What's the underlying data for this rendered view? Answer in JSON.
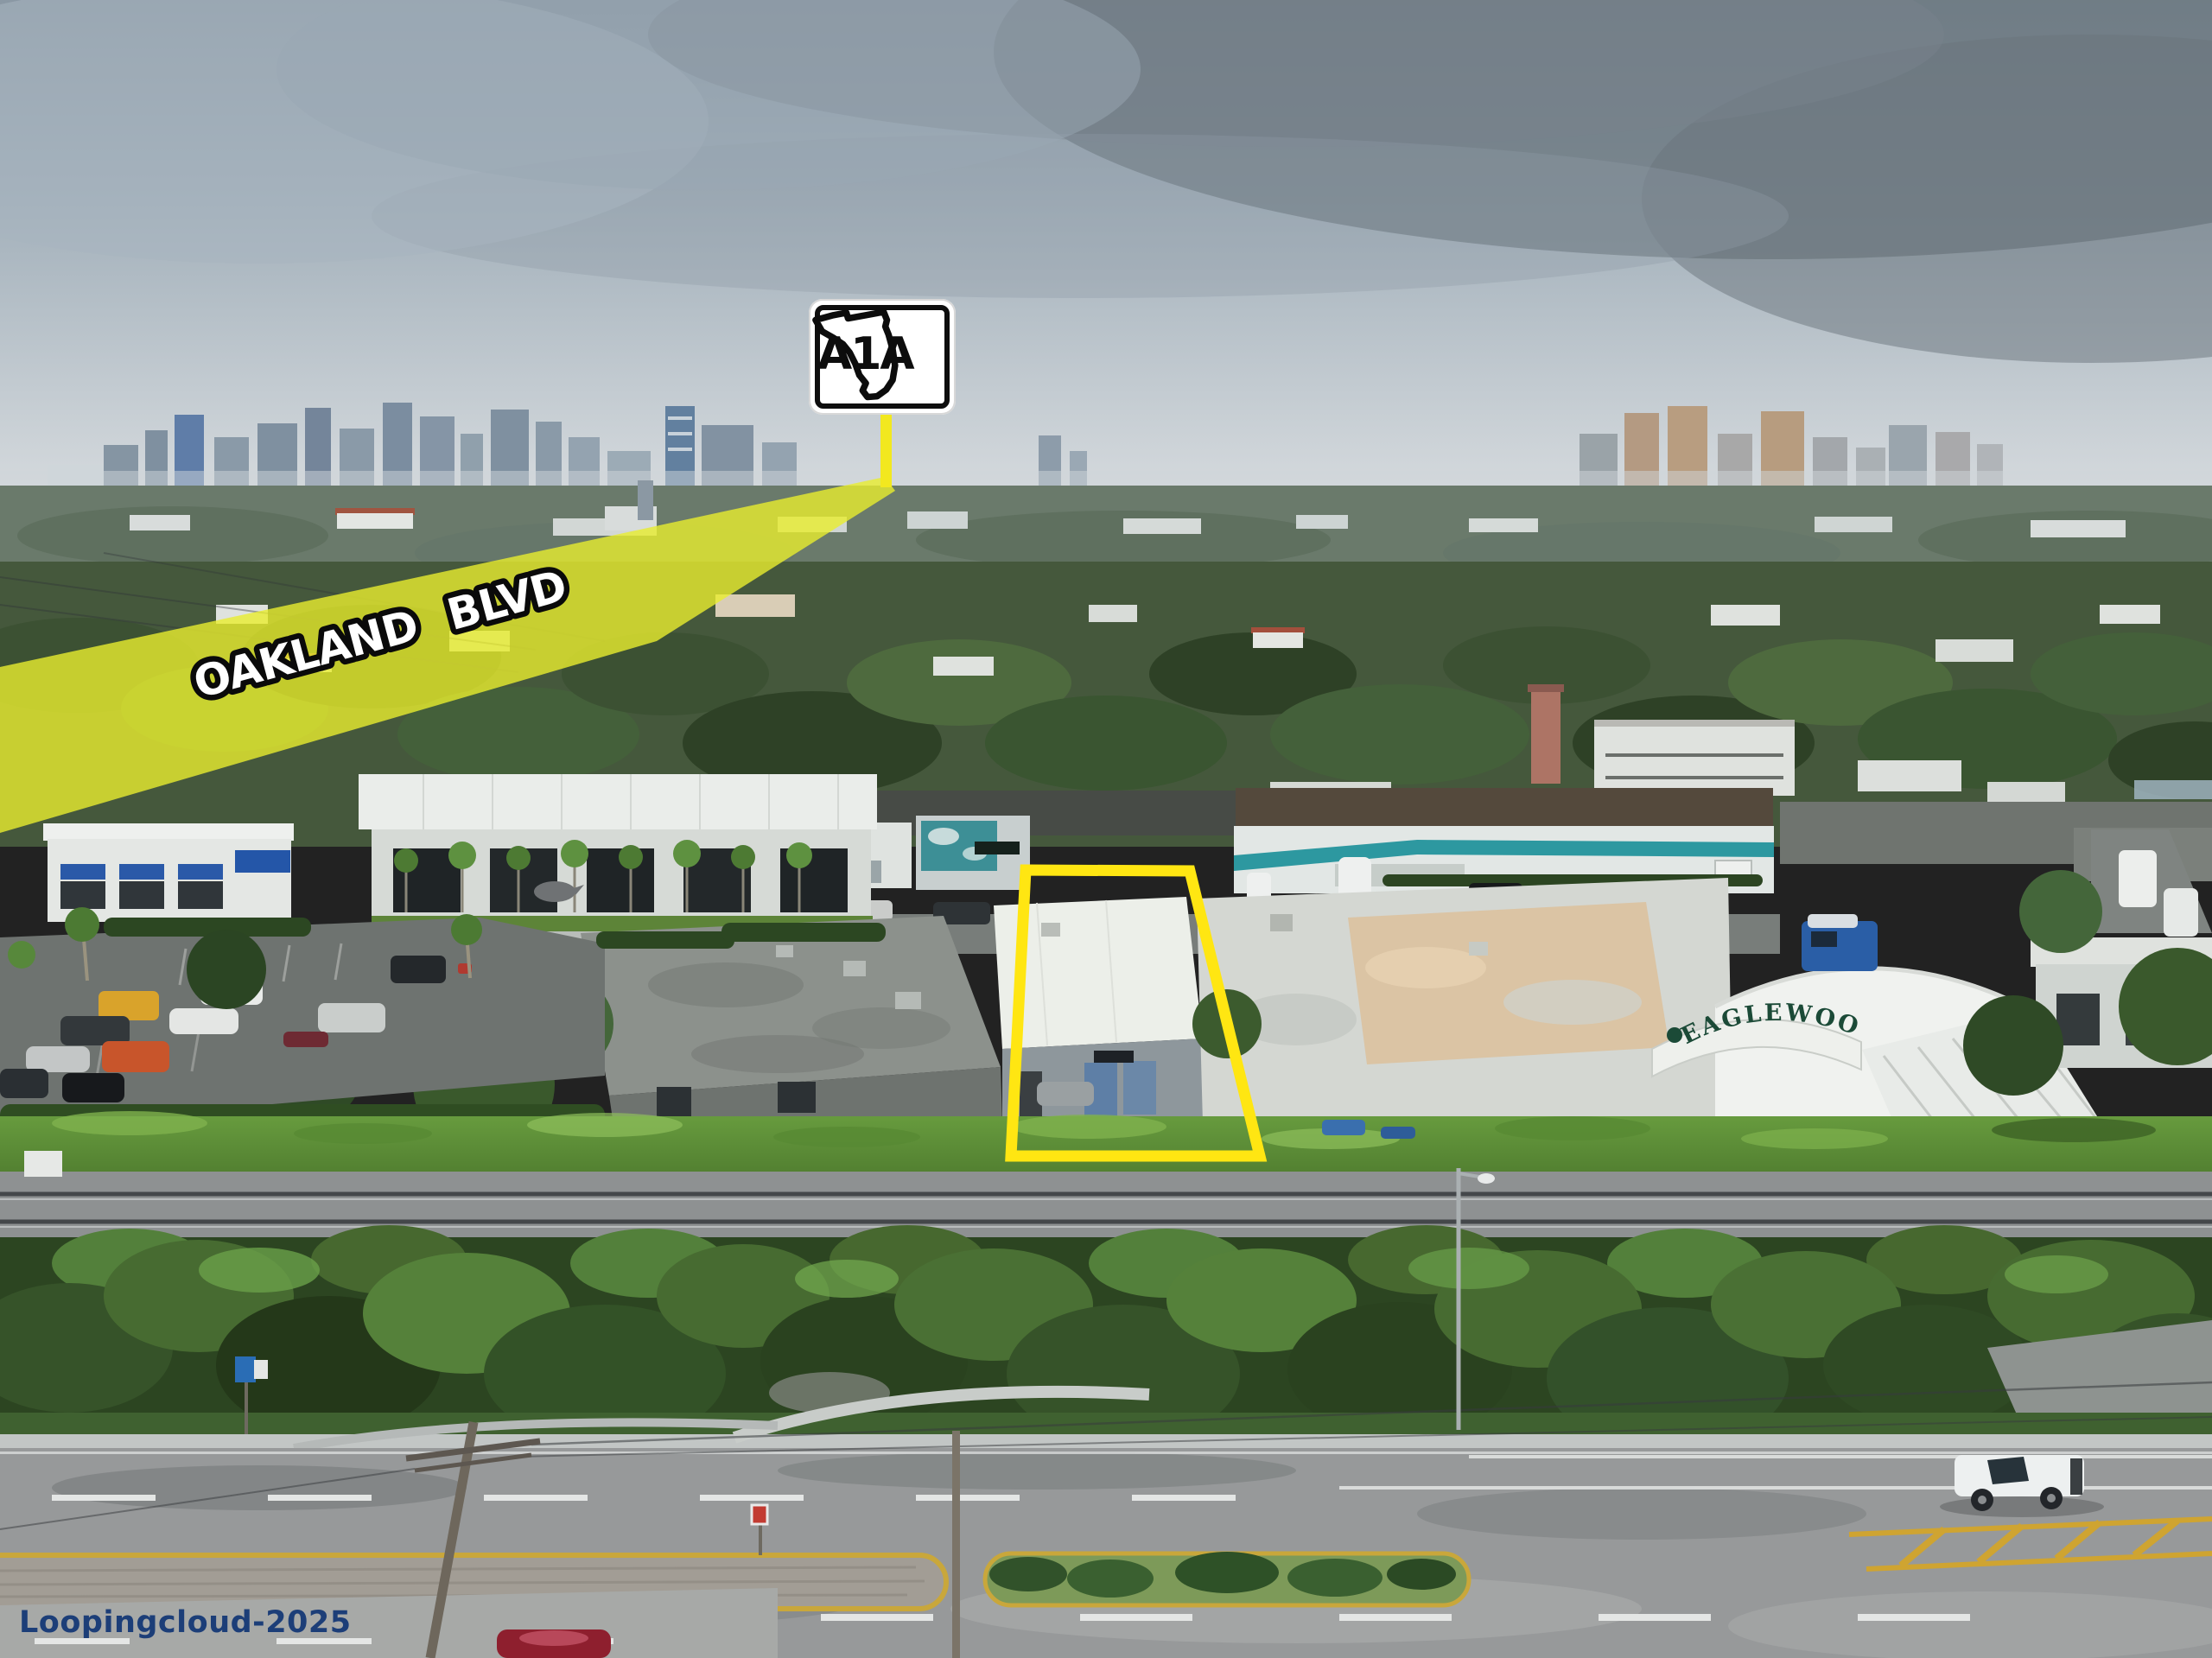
{
  "annotations": {
    "street_label": "OAKLAND BLVD",
    "route_shield_label": "A1A",
    "street_band_color": "#e9ed2e",
    "property_outline_color": "#ffe612",
    "shield_pointer_color": "#f2e81f"
  },
  "scene": {
    "eaglewood_sign": "EAGLEWOOD",
    "eaglewood_sign_color": "#1b4a37"
  },
  "watermark": {
    "text": "Loopingcloud-2025",
    "color": "#1c3e78"
  }
}
